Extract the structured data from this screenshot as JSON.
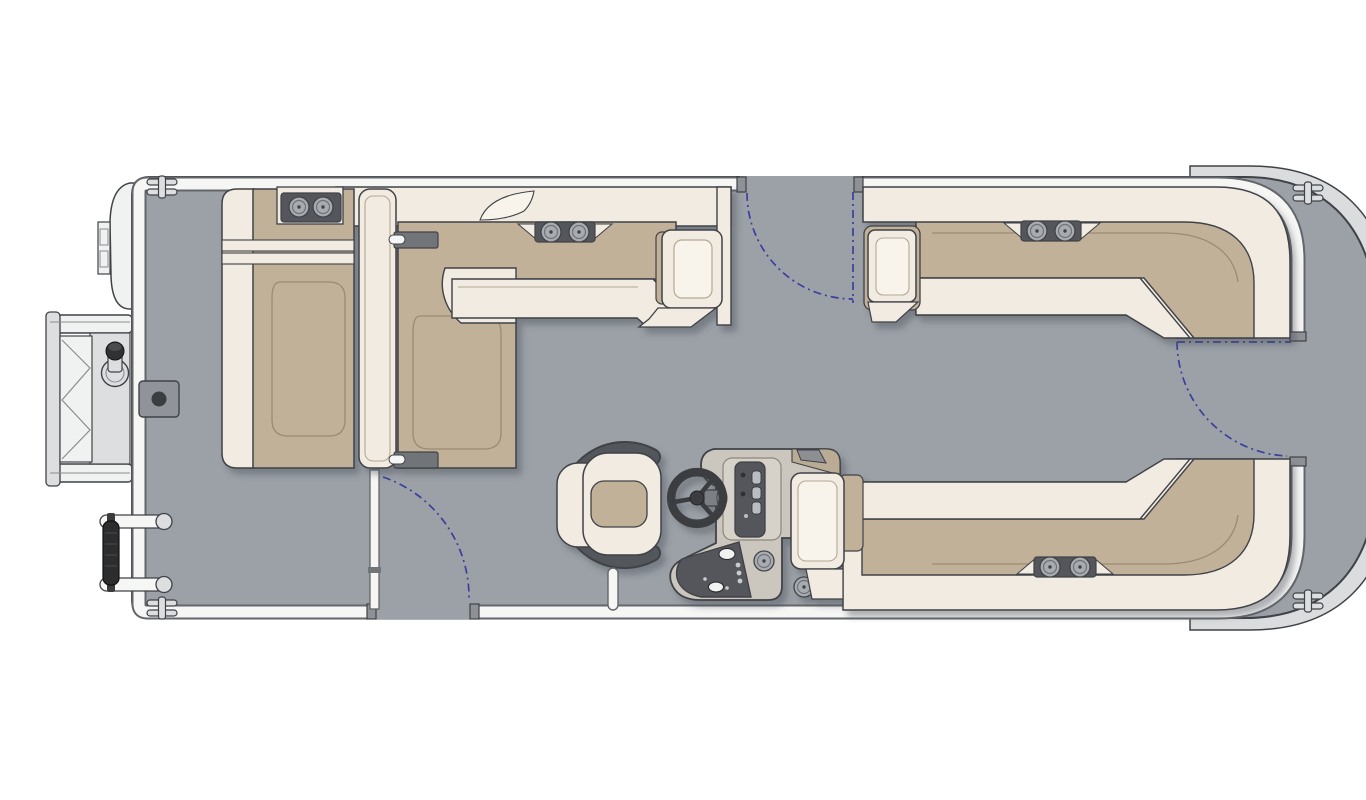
{
  "diagram": {
    "type": "boat-floor-plan",
    "subject": "pontoon boat deck layout, top view, bow to the right"
  },
  "canvas": {
    "width": 1366,
    "height": 768
  },
  "colors": {
    "background": "#ffffff",
    "deck": "#9ba1a7",
    "hull_band": "#dadcde",
    "outline": "#3f4246",
    "fence_white": "#f6f6f5",
    "fence_edge": "#63666a",
    "seat_cream": "#f1ebe2",
    "seat_cream_light": "#f8f4ec",
    "cushion_tan": "#c2b199",
    "contour_tan": "#9a8b73",
    "contour_cream": "#b4a892",
    "hardware_gray": "#dcdee0",
    "equip_white": "#f0f1f1",
    "ladder_line": "#8a8d90",
    "bracket_gray": "#71757a",
    "panel_dark": "#54575b",
    "cup_gray": "#a8acb0",
    "cup_inner": "#6f7377",
    "console_body": "#ccc7be",
    "console_trim": "#b9ab94",
    "console_trim_dark": "#8d8f93",
    "dash_surround": "#d7d2c9",
    "gauge_light": "#b9bdc1",
    "shaft_gray": "#7c8084",
    "dot_light": "#c9cbcd",
    "wheel_dark": "#3a3d40",
    "chair_frame": "#53565a",
    "gate_blue": "#3d3f9e",
    "gate_post": "#8e9296",
    "table_gray": "#90949a",
    "knob_dark": "#2f3133",
    "fender_dark": "#2c2d2f",
    "shadow": "#4a5058"
  },
  "components": {
    "hull": "pontoon deck with rounded bow (right) and square stern (left)",
    "fence": "perimeter fence rail with three gate openings",
    "gates": "port side gate, bow gate and starboard side gate with blue dashed swing arcs",
    "stern_platform": "stern swim platform with folding boarding ladder and ski tow pylon",
    "outboard_motor": "outboard motor pod at stern port corner",
    "stern_l_lounge": "aft-facing stern bench with cupholders",
    "aft_facing_lounge": "forward L-lounge group with partition backrest and armrest",
    "port_bow_lounge": "port bow wraparound lounge with armrest and cupholders",
    "starboard_bow_lounge": "starboard bow wraparound lounge with armrest and cupholders",
    "helm_console": "helm console with windscreen, instrument cluster, switch panel and two cupholders",
    "steering_wheel": "three-spoke steering wheel",
    "captains_chair": "swivel captain's chair with bolster frame",
    "table_base": "flush table base mount on deck",
    "fender_rack": "rail-mounted fender at stern port quarter",
    "cleats": "four mooring cleats",
    "grab_post": "deck grab post beside helm chair"
  }
}
